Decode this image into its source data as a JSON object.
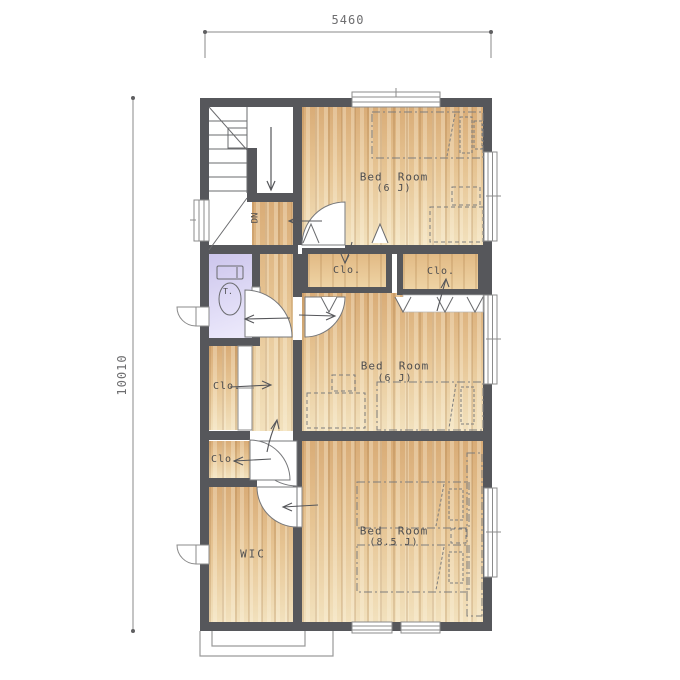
{
  "dimensions": {
    "width_label": "5460",
    "height_label": "10010"
  },
  "stairs": {
    "down_label": "DN"
  },
  "rooms": {
    "bedroom_top": {
      "name": "Bed  Room",
      "size": "(6 J)"
    },
    "bedroom_middle": {
      "name": "Bed  Room",
      "size": "(6 J)"
    },
    "bedroom_bottom": {
      "name": "Bed  Room",
      "size": "(8.5 J)"
    },
    "closet_bedroom_top": {
      "label": "Clo."
    },
    "closet_bedroom_middle": {
      "label": "Clo."
    },
    "closet_hall": {
      "label": "Clo."
    },
    "closet_lower": {
      "label": "Clo."
    },
    "walk_in_closet": {
      "label": "WIC"
    },
    "toilet": {
      "label": "T."
    }
  },
  "colors": {
    "wall": "#56575b",
    "wood_floor": "#e6c493",
    "toilet_floor": "#d9d4f2",
    "line": "#6a6b6e"
  }
}
